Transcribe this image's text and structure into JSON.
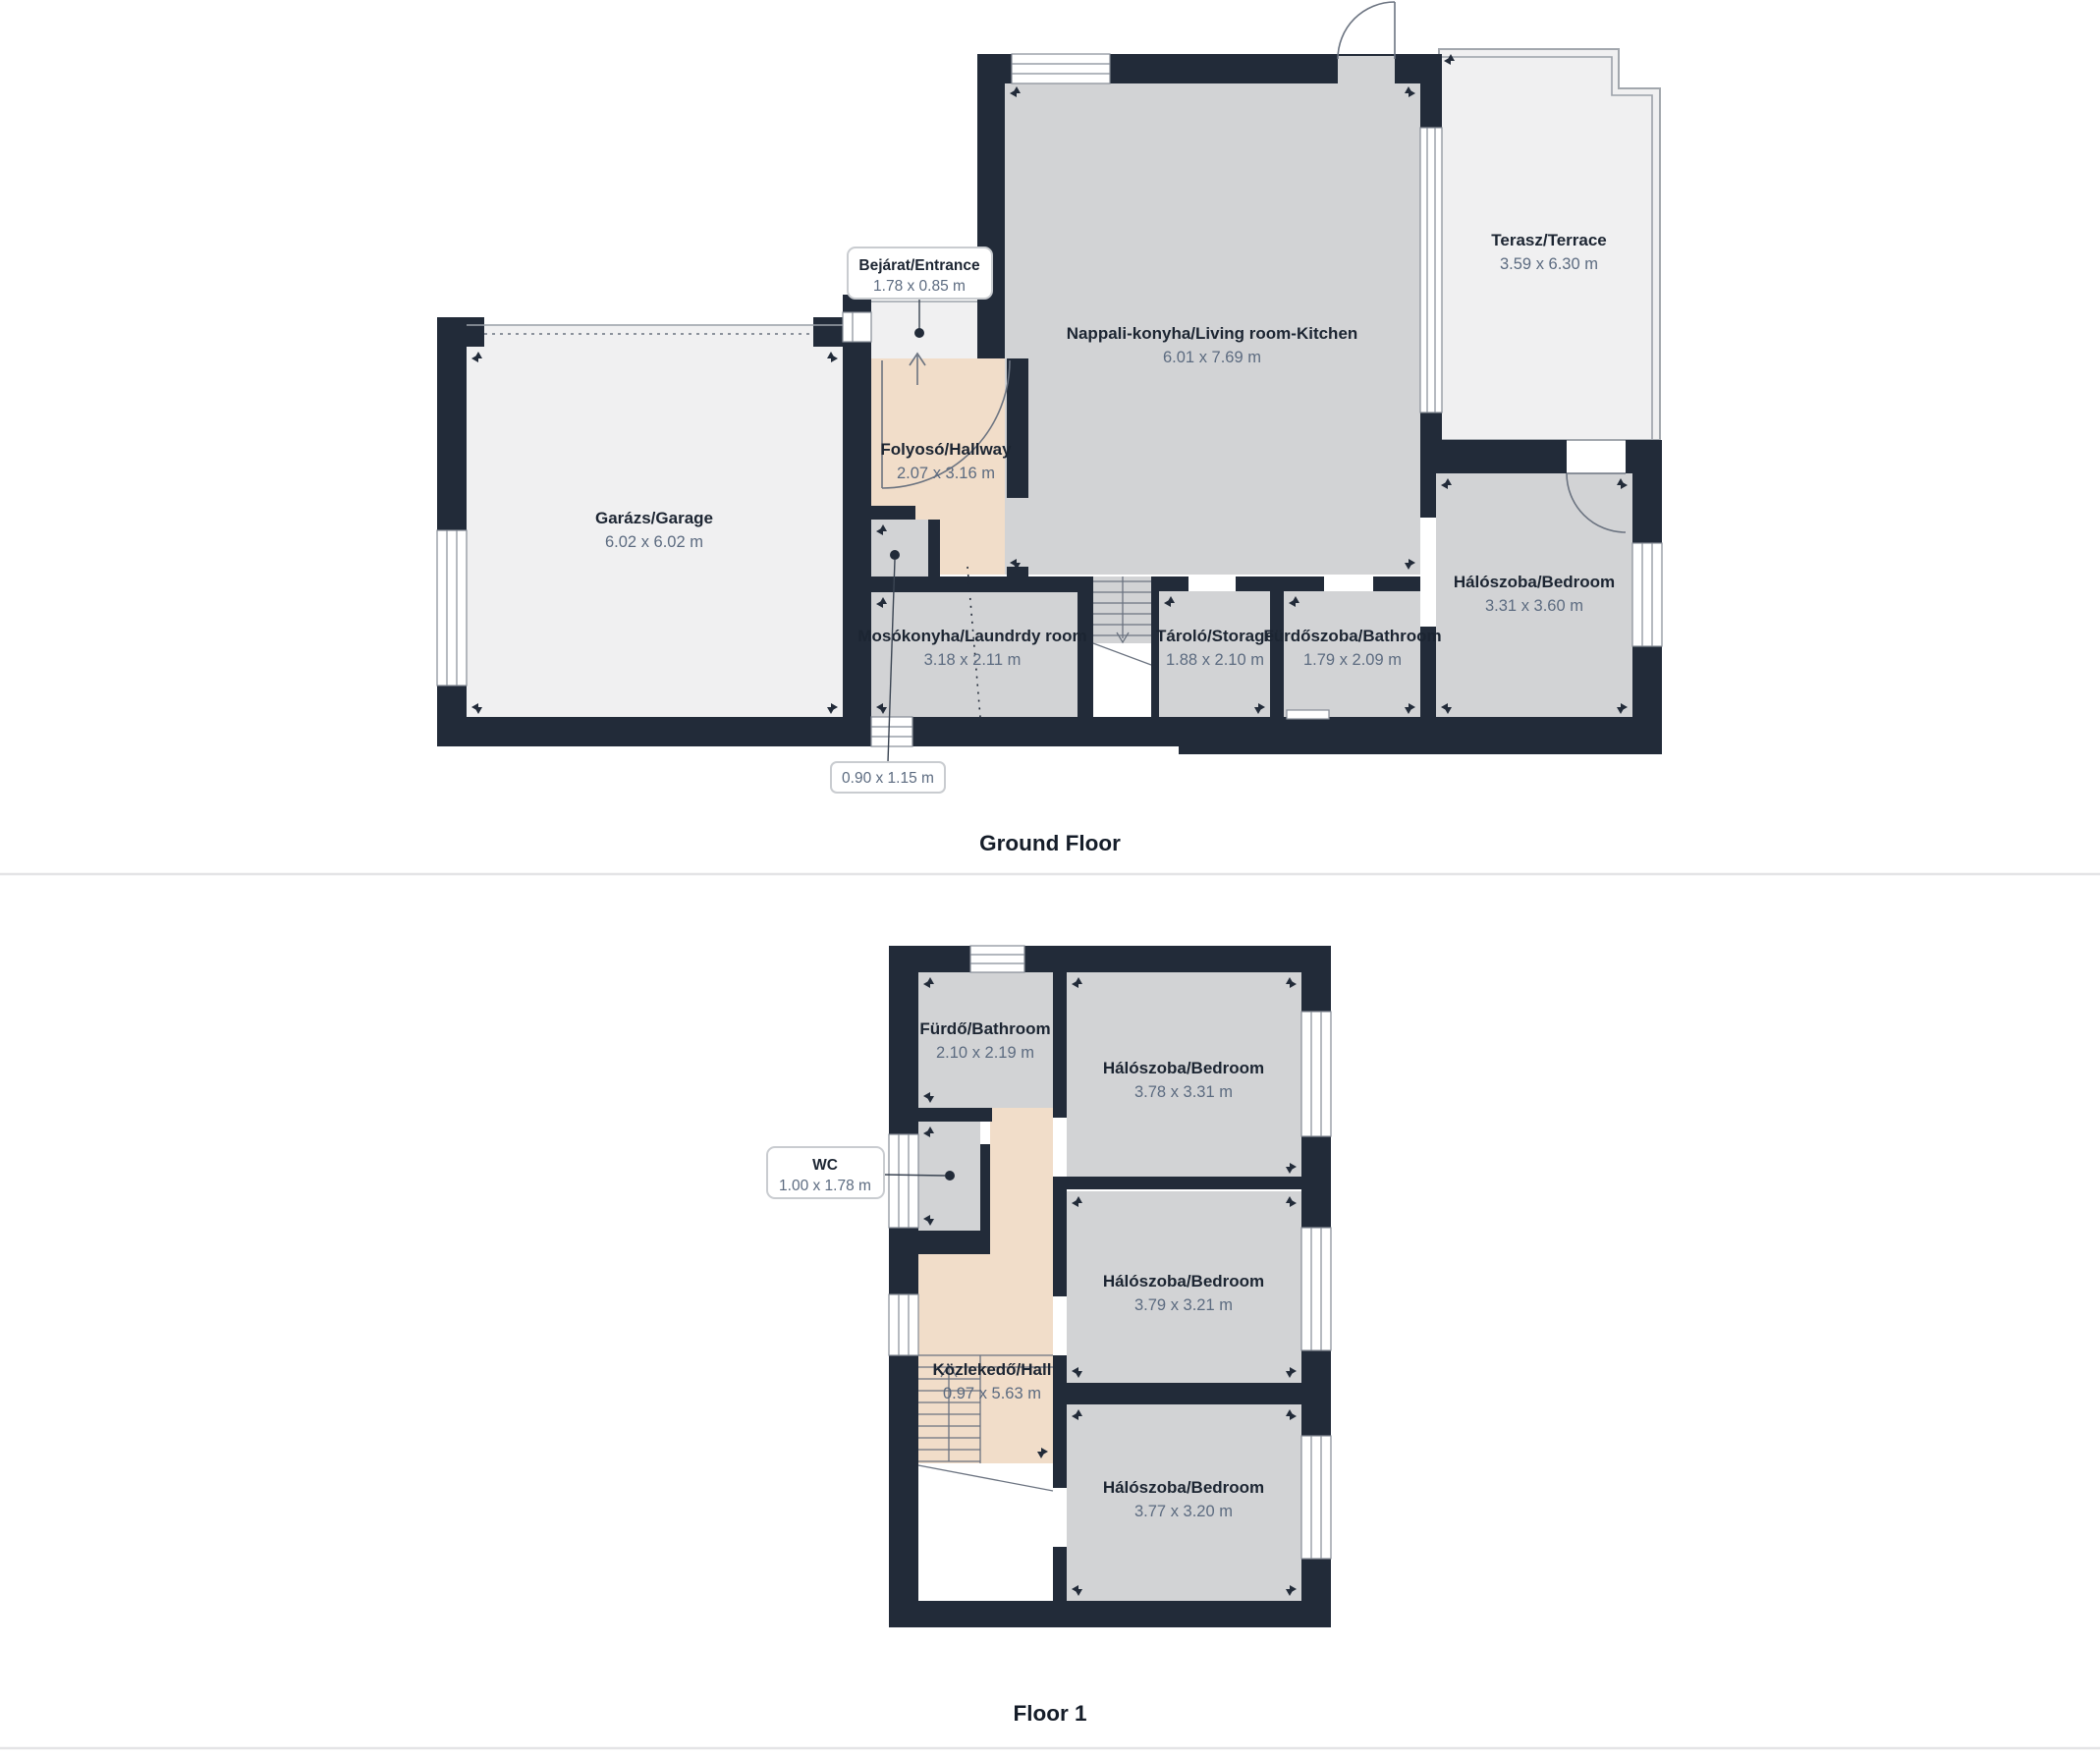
{
  "floors": [
    {
      "caption": "Ground Floor",
      "rooms": {
        "garage": {
          "name": "Garázs/Garage",
          "dims": "6.02 x 6.02 m"
        },
        "hallway": {
          "name": "Folyosó/Hallway",
          "dims": "2.07 x 3.16 m"
        },
        "living": {
          "name": "Nappali-konyha/Living room-Kitchen",
          "dims": "6.01 x 7.69 m"
        },
        "terrace": {
          "name": "Terasz/Terrace",
          "dims": "3.59 x 6.30 m"
        },
        "laundry": {
          "name": "Mosókonyha/Laundrdy room",
          "dims": "3.18 x 2.11 m"
        },
        "storage": {
          "name": "Tároló/Storage",
          "dims": "1.88 x 2.10 m"
        },
        "bathroom": {
          "name": "Fürdőszoba/Bathroom",
          "dims": "1.79 x 2.09 m"
        },
        "bedroom": {
          "name": "Hálószoba/Bedroom",
          "dims": "3.31 x 3.60 m"
        }
      },
      "callouts": {
        "entrance": {
          "name": "Bejárat/Entrance",
          "dims": "1.78 x 0.85 m"
        },
        "small_wc": {
          "dims": "0.90 x 1.15 m"
        }
      }
    },
    {
      "caption": "Floor 1",
      "rooms": {
        "bathroom": {
          "name": "Fürdő/Bathroom",
          "dims": "2.10 x 2.19 m"
        },
        "bedroom1": {
          "name": "Hálószoba/Bedroom",
          "dims": "3.78 x 3.31 m"
        },
        "bedroom2": {
          "name": "Hálószoba/Bedroom",
          "dims": "3.79 x 3.21 m"
        },
        "hall": {
          "name": "Közlekedő/Hall",
          "dims": "0.97 x 5.63 m"
        },
        "bedroom3": {
          "name": "Hálószoba/Bedroom",
          "dims": "3.77 x 3.20 m"
        }
      },
      "callouts": {
        "wc": {
          "name": "WC",
          "dims": "1.00 x 1.78 m"
        }
      }
    }
  ],
  "colors": {
    "wall": "#222b39",
    "room_gray": "#d2d3d5",
    "room_light": "#f0f0f1",
    "hall_peach": "#f1ddc9",
    "room_name_text": "#1c2532",
    "dims_text": "#5c6b80",
    "divider": "#e4e4e6"
  }
}
